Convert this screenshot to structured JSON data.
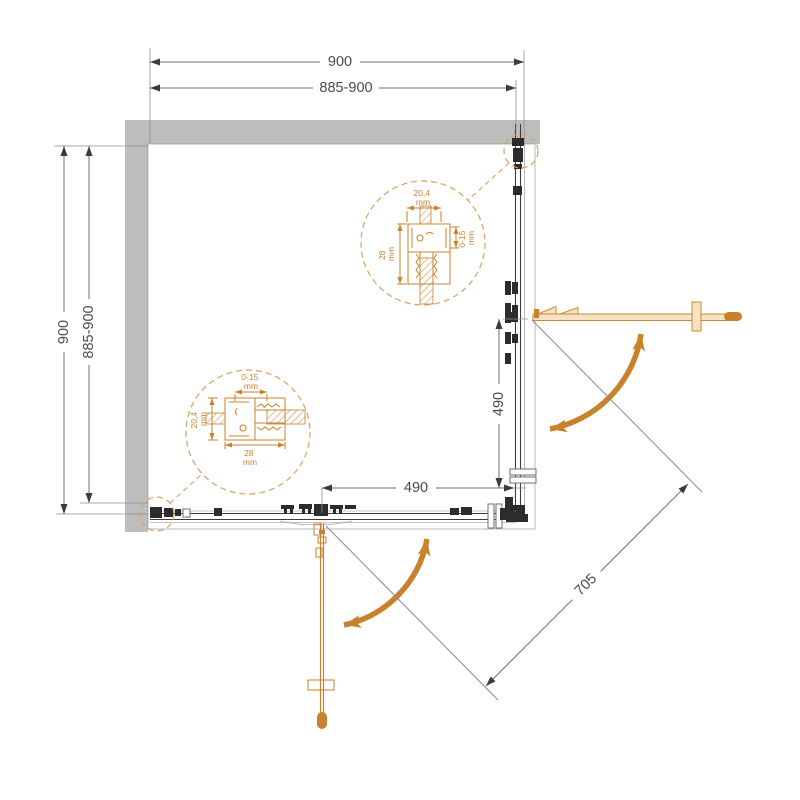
{
  "drawing": {
    "type": "shower-enclosure-corner-entry-plan",
    "colors": {
      "accent_orange": "#C8822C",
      "accent_orange_light": "#F5E3C4",
      "callout_orange": "#D9A160",
      "wall_gray": "#BDBDBD",
      "line_gray": "#6E6E6E",
      "text_gray": "#4A4A4A"
    },
    "dims": {
      "top_total": "900",
      "top_range": "885-900",
      "side_total": "900",
      "side_range": "885-900",
      "door_bottom": "490",
      "door_right": "490",
      "diagonal": "705"
    },
    "detail_top_right": {
      "width_value": "20,4",
      "width_unit": "mm",
      "depth_value": "28",
      "depth_unit": "mm",
      "adjust_value": "0-15",
      "adjust_unit": "mm"
    },
    "detail_bottom_left": {
      "adjust_value": "0-15",
      "adjust_unit": "mm",
      "width_value": "20,4",
      "width_unit": "mm",
      "depth_value": "28",
      "depth_unit": "mm"
    }
  }
}
